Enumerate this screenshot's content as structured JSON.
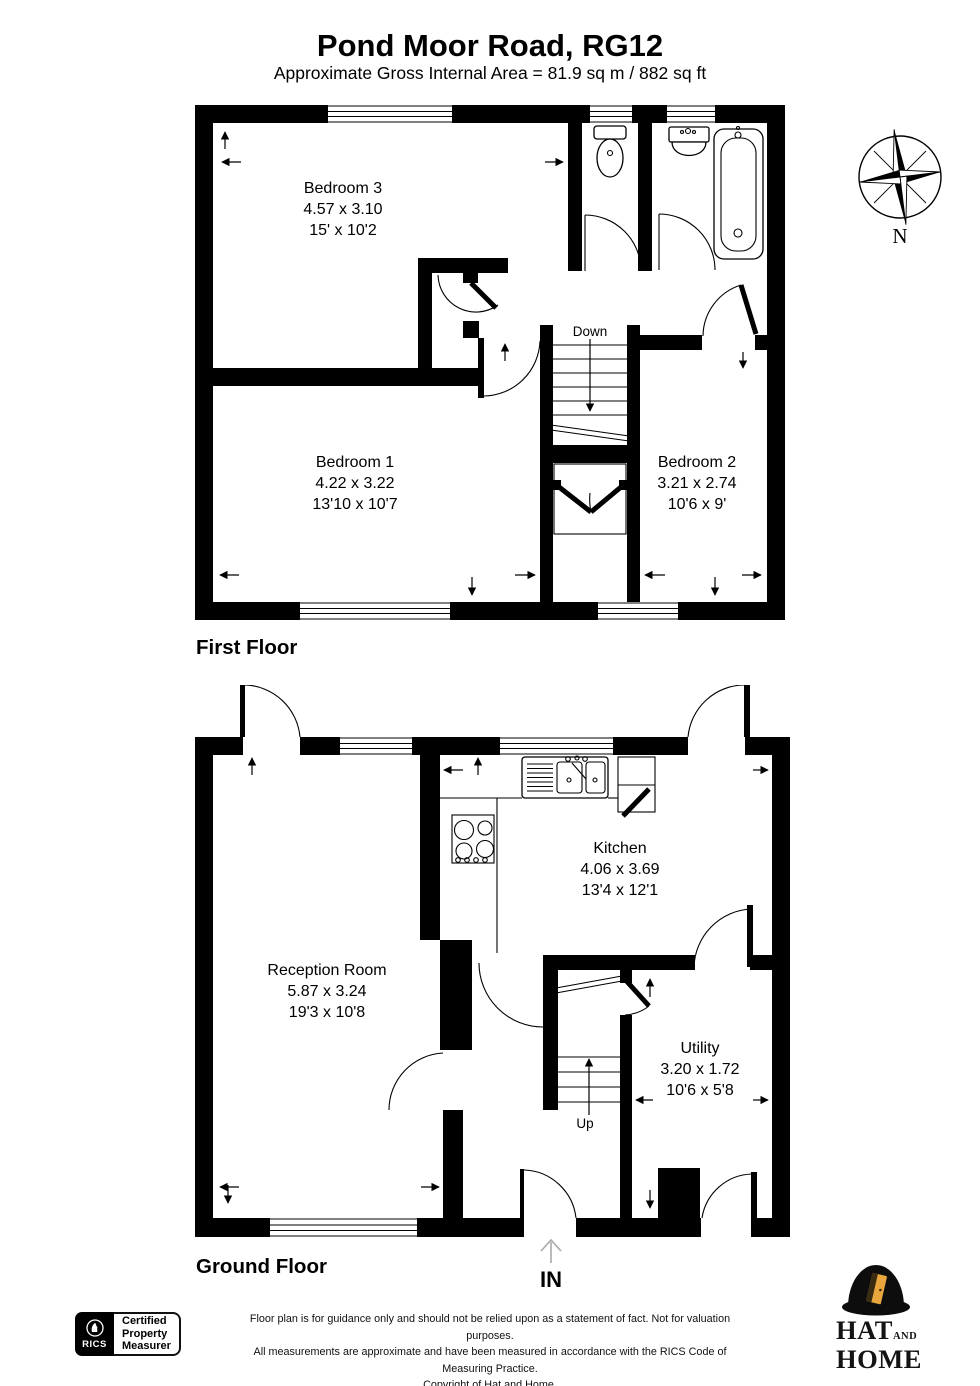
{
  "header": {
    "title": "Pond Moor Road, RG12",
    "subtitle": "Approximate Gross Internal Area = 81.9 sq m / 882 sq ft"
  },
  "first_floor": {
    "label": "First Floor",
    "stairs_label": "Down",
    "rooms": {
      "bedroom3": {
        "name": "Bedroom 3",
        "metric": "4.57 x 3.10",
        "imperial": "15' x 10'2"
      },
      "bedroom1": {
        "name": "Bedroom 1",
        "metric": "4.22 x 3.22",
        "imperial": "13'10 x 10'7"
      },
      "bedroom2": {
        "name": "Bedroom 2",
        "metric": "3.21 x 2.74",
        "imperial": "10'6 x 9'"
      }
    }
  },
  "ground_floor": {
    "label": "Ground Floor",
    "stairs_label": "Up",
    "entrance_label": "IN",
    "rooms": {
      "reception": {
        "name": "Reception Room",
        "metric": "5.87 x 3.24",
        "imperial": "19'3 x 10'8"
      },
      "kitchen": {
        "name": "Kitchen",
        "metric": "4.06 x 3.69",
        "imperial": "13'4 x 12'1"
      },
      "utility": {
        "name": "Utility",
        "metric": "3.20 x 1.72",
        "imperial": "10'6 x 5'8"
      }
    }
  },
  "compass": {
    "north_label": "N"
  },
  "footer": {
    "rics_badge": {
      "brand": "RICS",
      "certification": [
        "Certified",
        "Property",
        "Measurer"
      ]
    },
    "disclaimer": [
      "Floor plan is for guidance only and should not be relied upon as a statement of fact. Not for valuation purposes.",
      "All measurements are approximate and have been measured in accordance with the RICS Code of Measuring Practice.",
      "Copyright of Hat and Home."
    ],
    "agency": {
      "word1": "HAT",
      "word2": "AND",
      "word3": "HOME"
    }
  },
  "colors": {
    "ink": "#000000",
    "door_gold": "#E8A63C",
    "entrance_arrow_grey": "#a8a8a8"
  }
}
